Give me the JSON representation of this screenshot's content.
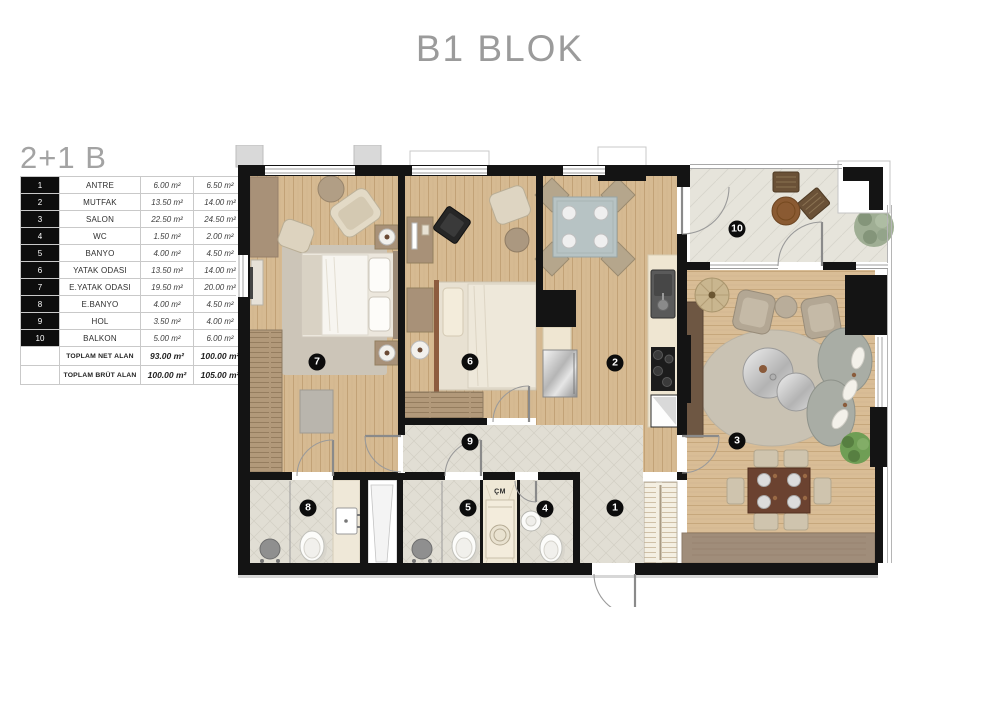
{
  "header": {
    "title": "B1 BLOK"
  },
  "plan": {
    "label": "2+1 B",
    "table": {
      "rows": [
        {
          "no": "1",
          "name": "ANTRE",
          "net": "6.00 m²",
          "gross": "6.50 m²"
        },
        {
          "no": "2",
          "name": "MUTFAK",
          "net": "13.50 m²",
          "gross": "14.00 m²"
        },
        {
          "no": "3",
          "name": "SALON",
          "net": "22.50 m²",
          "gross": "24.50 m²"
        },
        {
          "no": "4",
          "name": "WC",
          "net": "1.50 m²",
          "gross": "2.00 m²"
        },
        {
          "no": "5",
          "name": "BANYO",
          "net": "4.00 m²",
          "gross": "4.50 m²"
        },
        {
          "no": "6",
          "name": "YATAK ODASI",
          "net": "13.50 m²",
          "gross": "14.00 m²"
        },
        {
          "no": "7",
          "name": "E.YATAK ODASI",
          "net": "19.50 m²",
          "gross": "20.00 m²"
        },
        {
          "no": "8",
          "name": "E.BANYO",
          "net": "4.00 m²",
          "gross": "4.50 m²"
        },
        {
          "no": "9",
          "name": "HOL",
          "net": "3.50 m²",
          "gross": "4.00 m²"
        },
        {
          "no": "10",
          "name": "BALKON",
          "net": "5.00 m²",
          "gross": "6.00 m²"
        }
      ],
      "totals": [
        {
          "label": "TOPLAM NET ALAN",
          "net": "93.00 m²",
          "gross": "100.00 m²"
        },
        {
          "label": "TOPLAM BRÜT ALAN",
          "net": "100.00 m²",
          "gross": "105.00 m²"
        }
      ]
    }
  },
  "floorplan": {
    "cm_label": "ÇM",
    "badges": [
      "1",
      "2",
      "3",
      "4",
      "5",
      "6",
      "7",
      "8",
      "9",
      "10"
    ],
    "colors": {
      "wall": "#141414",
      "wood": "#d6ba92",
      "tile": "#e1ded4",
      "dining_table": "#6b4230"
    }
  }
}
